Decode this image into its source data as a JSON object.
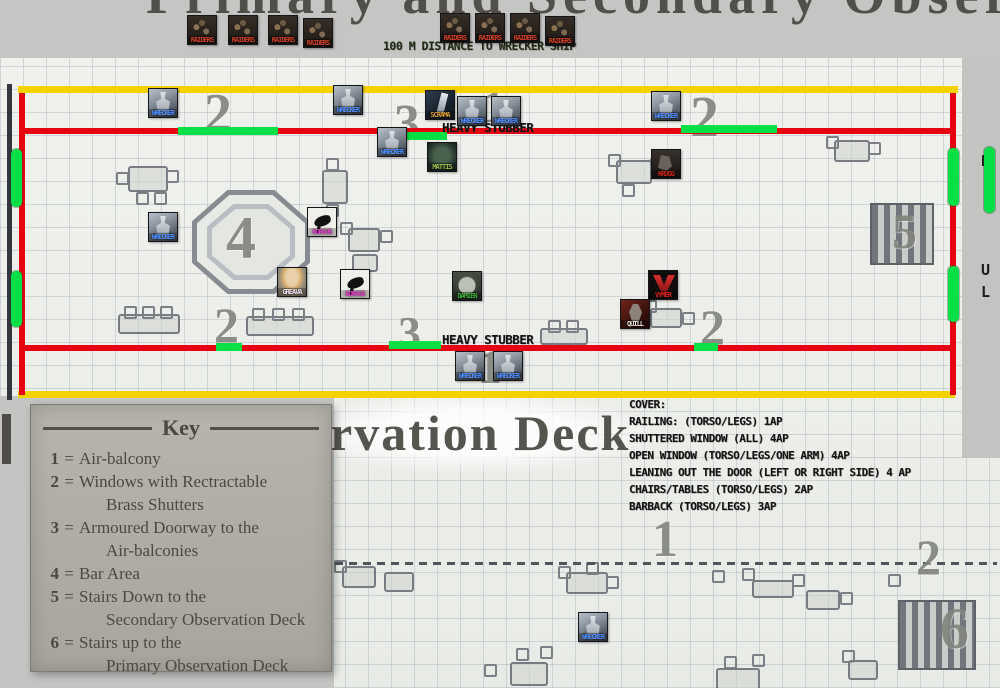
{
  "page": {
    "title_top_partial": "Primary and Secondary Obser",
    "title_mid_partial": "rvation Deck",
    "edge_letters": [
      {
        "t": "D",
        "x": 981,
        "y": 152
      },
      {
        "t": "U",
        "x": 981,
        "y": 261
      },
      {
        "t": "L",
        "x": 981,
        "y": 283
      }
    ]
  },
  "top_strip": {
    "distance_label": "100 M DISTANCE TO WRECKER SHIP"
  },
  "map": {
    "labels": {
      "heavy_stubber": "HEAVY STUBBER"
    },
    "palette": {
      "boundary_yellow": "#f2d300",
      "railing_red": "#e60410",
      "window_green": "#06df45",
      "page_grey": "#c6c6c4",
      "paper": "#eef0ec",
      "map_ink": "#83867f"
    },
    "overlay_lines": [
      {
        "name": "boundary-line-top",
        "c": "boundary_yellow",
        "x": 18,
        "y": 86,
        "w": 940,
        "h": 7
      },
      {
        "name": "boundary-line-bottom",
        "c": "boundary_yellow",
        "x": 18,
        "y": 391,
        "w": 937,
        "h": 7
      },
      {
        "name": "railing-line-left",
        "c": "railing_red",
        "x": 19,
        "y": 93,
        "w": 6,
        "h": 302
      },
      {
        "name": "railing-line-right",
        "c": "railing_red",
        "x": 950,
        "y": 93,
        "w": 6,
        "h": 302
      },
      {
        "name": "railing-line-upper",
        "c": "railing_red",
        "x": 19,
        "y": 128,
        "w": 937,
        "h": 6
      },
      {
        "name": "railing-line-lower",
        "c": "railing_red",
        "x": 19,
        "y": 345,
        "w": 937,
        "h": 6
      },
      {
        "name": "window-marker",
        "c": "window_green",
        "x": 178,
        "y": 127,
        "w": 100,
        "h": 8
      },
      {
        "name": "window-marker",
        "c": "window_green",
        "x": 389,
        "y": 132,
        "w": 58,
        "h": 8
      },
      {
        "name": "window-marker",
        "c": "window_green",
        "x": 681,
        "y": 125,
        "w": 96,
        "h": 8
      },
      {
        "name": "window-marker",
        "c": "window_green",
        "x": 216,
        "y": 343,
        "w": 26,
        "h": 8
      },
      {
        "name": "window-marker",
        "c": "window_green",
        "x": 389,
        "y": 341,
        "w": 52,
        "h": 8
      },
      {
        "name": "window-marker",
        "c": "window_green",
        "x": 694,
        "y": 343,
        "w": 24,
        "h": 8
      },
      {
        "name": "window-marker",
        "c": "window_green",
        "x": 11,
        "y": 149,
        "w": 11,
        "h": 58,
        "round": true
      },
      {
        "name": "window-marker",
        "c": "window_green",
        "x": 11,
        "y": 271,
        "w": 11,
        "h": 56,
        "round": true
      },
      {
        "name": "window-marker",
        "c": "window_green",
        "x": 948,
        "y": 148,
        "w": 11,
        "h": 58,
        "round": true
      },
      {
        "name": "window-marker",
        "c": "window_green",
        "x": 948,
        "y": 266,
        "w": 11,
        "h": 56,
        "round": true
      },
      {
        "name": "window-marker",
        "c": "window_green",
        "x": 984,
        "y": 147,
        "w": 11,
        "h": 66,
        "round": true
      }
    ],
    "numbers": [
      {
        "t": "2",
        "x": 204,
        "y": 86,
        "s": 56
      },
      {
        "t": "3",
        "x": 394,
        "y": 98,
        "s": 52
      },
      {
        "t": "1",
        "x": 482,
        "y": 84,
        "s": 46
      },
      {
        "t": "2",
        "x": 690,
        "y": 88,
        "s": 58
      },
      {
        "t": "4",
        "x": 226,
        "y": 208,
        "s": 60
      },
      {
        "t": "5",
        "x": 892,
        "y": 206,
        "s": 50
      },
      {
        "t": "2",
        "x": 214,
        "y": 300,
        "s": 50
      },
      {
        "t": "3",
        "x": 398,
        "y": 310,
        "s": 46
      },
      {
        "t": "2",
        "x": 700,
        "y": 302,
        "s": 50
      },
      {
        "t": "1",
        "x": 478,
        "y": 344,
        "s": 48
      },
      {
        "t": "1",
        "x": 652,
        "y": 514,
        "s": 52
      },
      {
        "t": "2",
        "x": 916,
        "y": 532,
        "s": 50
      },
      {
        "t": "6",
        "x": 940,
        "y": 600,
        "s": 58
      }
    ],
    "tokens": [
      {
        "label": "RAIDERS",
        "type": "raider",
        "lc": "#d04028",
        "x": 187,
        "y": 15
      },
      {
        "label": "RAIDERS",
        "type": "raider",
        "lc": "#d04028",
        "x": 228,
        "y": 15
      },
      {
        "label": "RAIDERS",
        "type": "raider",
        "lc": "#d04028",
        "x": 268,
        "y": 15
      },
      {
        "label": "RAIDERS",
        "type": "raider",
        "lc": "#d04028",
        "x": 303,
        "y": 18
      },
      {
        "label": "RAIDERS",
        "type": "raider",
        "lc": "#d04028",
        "x": 440,
        "y": 13
      },
      {
        "label": "RAIDERS",
        "type": "raider",
        "lc": "#d04028",
        "x": 475,
        "y": 13
      },
      {
        "label": "RAIDERS",
        "type": "raider",
        "lc": "#d04028",
        "x": 510,
        "y": 13
      },
      {
        "label": "RAIDERS",
        "type": "raider",
        "lc": "#d04028",
        "x": 545,
        "y": 16
      },
      {
        "label": "WRECKER",
        "type": "wrecker",
        "lc": "#4f8dff",
        "x": 148,
        "y": 88
      },
      {
        "label": "WRECKER",
        "type": "wrecker",
        "lc": "#4f8dff",
        "x": 333,
        "y": 85
      },
      {
        "label": "SCRAMA",
        "type": "scrama",
        "lc": "#d89a30",
        "x": 425,
        "y": 90
      },
      {
        "label": "WRECKER",
        "type": "wrecker",
        "lc": "#4f8dff",
        "x": 457,
        "y": 96
      },
      {
        "label": "WRECKER",
        "type": "wrecker",
        "lc": "#4f8dff",
        "x": 491,
        "y": 96
      },
      {
        "label": "WRECKER",
        "type": "wrecker",
        "lc": "#4f8dff",
        "x": 377,
        "y": 127
      },
      {
        "label": "MATTIS",
        "type": "mattis",
        "lc": "#9cc04e",
        "x": 427,
        "y": 142
      },
      {
        "label": "WRECKER",
        "type": "wrecker",
        "lc": "#4f8dff",
        "x": 651,
        "y": 91
      },
      {
        "label": "KRUGG",
        "type": "krugg",
        "lc": "#cc2418",
        "x": 651,
        "y": 149
      },
      {
        "label": "WRECKER",
        "type": "wrecker",
        "lc": "#4f8dff",
        "x": 148,
        "y": 212
      },
      {
        "label": "KORVUS",
        "type": "bird",
        "lc": "#e040c8",
        "x": 307,
        "y": 207
      },
      {
        "label": "GREAVA",
        "type": "greava",
        "lc": "#efe0ee",
        "x": 277,
        "y": 267
      },
      {
        "label": "KORVUS",
        "type": "bird",
        "lc": "#e040c8",
        "x": 340,
        "y": 269
      },
      {
        "label": "DAMIEN",
        "type": "damien",
        "lc": "#3fae3a",
        "x": 452,
        "y": 271
      },
      {
        "label": "VYMER",
        "type": "vymer",
        "lc": "#e02222",
        "x": 648,
        "y": 270
      },
      {
        "label": "QUILL",
        "type": "quill",
        "lc": "#eae4da",
        "x": 620,
        "y": 299
      },
      {
        "label": "WRECKER",
        "type": "wrecker",
        "lc": "#4f8dff",
        "x": 455,
        "y": 351
      },
      {
        "label": "WRECKER",
        "type": "wrecker",
        "lc": "#4f8dff",
        "x": 493,
        "y": 351
      },
      {
        "label": "WRECKER",
        "type": "wrecker",
        "lc": "#4f8dff",
        "x": 578,
        "y": 612
      }
    ],
    "furniture": [
      {
        "kind": "table",
        "x": 128,
        "y": 166,
        "w": 36,
        "h": 22
      },
      {
        "kind": "chair",
        "x": 116,
        "y": 172
      },
      {
        "kind": "chair",
        "x": 166,
        "y": 170
      },
      {
        "kind": "chair",
        "x": 136,
        "y": 192
      },
      {
        "kind": "chair",
        "x": 154,
        "y": 192
      },
      {
        "kind": "table",
        "x": 322,
        "y": 170,
        "w": 22,
        "h": 30
      },
      {
        "kind": "chair",
        "x": 326,
        "y": 158
      },
      {
        "kind": "chair",
        "x": 326,
        "y": 204
      },
      {
        "kind": "table",
        "x": 348,
        "y": 228,
        "w": 28,
        "h": 20
      },
      {
        "kind": "chair",
        "x": 340,
        "y": 222
      },
      {
        "kind": "chair",
        "x": 380,
        "y": 230
      },
      {
        "kind": "table",
        "x": 352,
        "y": 254,
        "w": 22,
        "h": 14
      },
      {
        "kind": "table",
        "x": 616,
        "y": 160,
        "w": 32,
        "h": 20
      },
      {
        "kind": "chair",
        "x": 608,
        "y": 154
      },
      {
        "kind": "chair",
        "x": 650,
        "y": 158
      },
      {
        "kind": "chair",
        "x": 622,
        "y": 184
      },
      {
        "kind": "table",
        "x": 834,
        "y": 140,
        "w": 32,
        "h": 18
      },
      {
        "kind": "chair",
        "x": 826,
        "y": 136
      },
      {
        "kind": "chair",
        "x": 868,
        "y": 142
      },
      {
        "kind": "table",
        "x": 118,
        "y": 314,
        "w": 58,
        "h": 16
      },
      {
        "kind": "chair",
        "x": 124,
        "y": 306
      },
      {
        "kind": "chair",
        "x": 142,
        "y": 306
      },
      {
        "kind": "chair",
        "x": 160,
        "y": 306
      },
      {
        "kind": "table",
        "x": 246,
        "y": 316,
        "w": 64,
        "h": 16
      },
      {
        "kind": "chair",
        "x": 252,
        "y": 308
      },
      {
        "kind": "chair",
        "x": 272,
        "y": 308
      },
      {
        "kind": "chair",
        "x": 292,
        "y": 308
      },
      {
        "kind": "table",
        "x": 540,
        "y": 328,
        "w": 44,
        "h": 13
      },
      {
        "kind": "chair",
        "x": 548,
        "y": 320
      },
      {
        "kind": "chair",
        "x": 566,
        "y": 320
      },
      {
        "kind": "table",
        "x": 650,
        "y": 308,
        "w": 28,
        "h": 16
      },
      {
        "kind": "chair",
        "x": 682,
        "y": 312
      },
      {
        "kind": "chair",
        "x": 644,
        "y": 300
      },
      {
        "kind": "stairs",
        "x": 870,
        "y": 203,
        "w": 60,
        "h": 58
      },
      {
        "kind": "table",
        "x": 342,
        "y": 566,
        "w": 30,
        "h": 18
      },
      {
        "kind": "chair",
        "x": 334,
        "y": 560
      },
      {
        "kind": "table",
        "x": 384,
        "y": 572,
        "w": 26,
        "h": 16
      },
      {
        "kind": "table",
        "x": 566,
        "y": 572,
        "w": 38,
        "h": 18
      },
      {
        "kind": "chair",
        "x": 558,
        "y": 566
      },
      {
        "kind": "chair",
        "x": 586,
        "y": 562
      },
      {
        "kind": "chair",
        "x": 606,
        "y": 576
      },
      {
        "kind": "chair",
        "x": 712,
        "y": 570
      },
      {
        "kind": "chair",
        "x": 742,
        "y": 568
      },
      {
        "kind": "table",
        "x": 752,
        "y": 580,
        "w": 38,
        "h": 14
      },
      {
        "kind": "chair",
        "x": 792,
        "y": 574
      },
      {
        "kind": "chair",
        "x": 888,
        "y": 574
      },
      {
        "kind": "table",
        "x": 806,
        "y": 590,
        "w": 30,
        "h": 16
      },
      {
        "kind": "chair",
        "x": 840,
        "y": 592
      },
      {
        "kind": "stairs",
        "x": 898,
        "y": 600,
        "w": 74,
        "h": 66
      },
      {
        "kind": "chair",
        "x": 516,
        "y": 648
      },
      {
        "kind": "chair",
        "x": 540,
        "y": 646
      },
      {
        "kind": "table",
        "x": 510,
        "y": 662,
        "w": 34,
        "h": 20
      },
      {
        "kind": "chair",
        "x": 484,
        "y": 664
      },
      {
        "kind": "chair",
        "x": 724,
        "y": 656
      },
      {
        "kind": "chair",
        "x": 752,
        "y": 654
      },
      {
        "kind": "table",
        "x": 716,
        "y": 668,
        "w": 40,
        "h": 18
      },
      {
        "kind": "chair",
        "x": 842,
        "y": 650
      },
      {
        "kind": "table",
        "x": 848,
        "y": 660,
        "w": 26,
        "h": 16
      }
    ]
  },
  "key_box": {
    "title": "Key",
    "entries": [
      {
        "n": "1",
        "lines": [
          "Air-balcony"
        ]
      },
      {
        "n": "2",
        "lines": [
          "Windows with Rectractable",
          "Brass Shutters"
        ]
      },
      {
        "n": "3",
        "lines": [
          "Armoured Doorway to the",
          "Air-balconies"
        ]
      },
      {
        "n": "4",
        "lines": [
          "Bar Area"
        ]
      },
      {
        "n": "5",
        "lines": [
          "Stairs Down to the",
          "Secondary Observation Deck"
        ]
      },
      {
        "n": "6",
        "lines": [
          "Stairs up to the",
          "Primary Observation Deck"
        ]
      }
    ]
  },
  "cover_notes": {
    "lines": [
      "COVER:",
      "RAILING: (TORSO/LEGS) 1AP",
      "SHUTTERED WINDOW (ALL) 4AP",
      "OPEN WINDOW (TORSO/LEGS/ONE ARM) 4AP",
      "LEANING OUT THE DOOR (LEFT OR RIGHT SIDE) 4 AP",
      "CHAIRS/TABLES (TORSO/LEGS) 2AP",
      "BARBACK (TORSO/LEGS) 3AP"
    ]
  }
}
